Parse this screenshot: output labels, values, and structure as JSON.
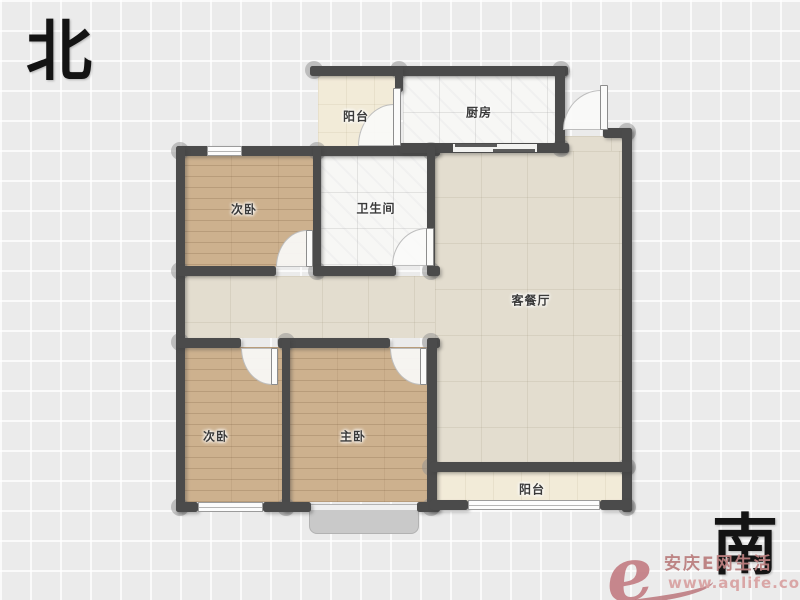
{
  "compass": {
    "north_label": "北",
    "south_label": "南"
  },
  "rooms": {
    "balcony_top": {
      "label": "阳台"
    },
    "kitchen": {
      "label": "厨房"
    },
    "bedroom_top": {
      "label": "次卧"
    },
    "bathroom": {
      "label": "卫生间"
    },
    "living": {
      "label": "客餐厅"
    },
    "bedroom_bottom": {
      "label": "次卧"
    },
    "master_bedroom": {
      "label": "主卧"
    },
    "balcony_bottom": {
      "label": "阳台"
    }
  },
  "watermark": {
    "logo_letter": "e",
    "site_name": "安庆E网生活",
    "url": "www.aqlife.com"
  },
  "colors": {
    "wall": "#4b4b4b",
    "wood_floor": "#cdb18e",
    "living_tile": "#e3ddcf",
    "white_tile": "#f7f7f5",
    "balcony_cream": "#f2ebd8",
    "watermark_pink": "#c2797f"
  }
}
